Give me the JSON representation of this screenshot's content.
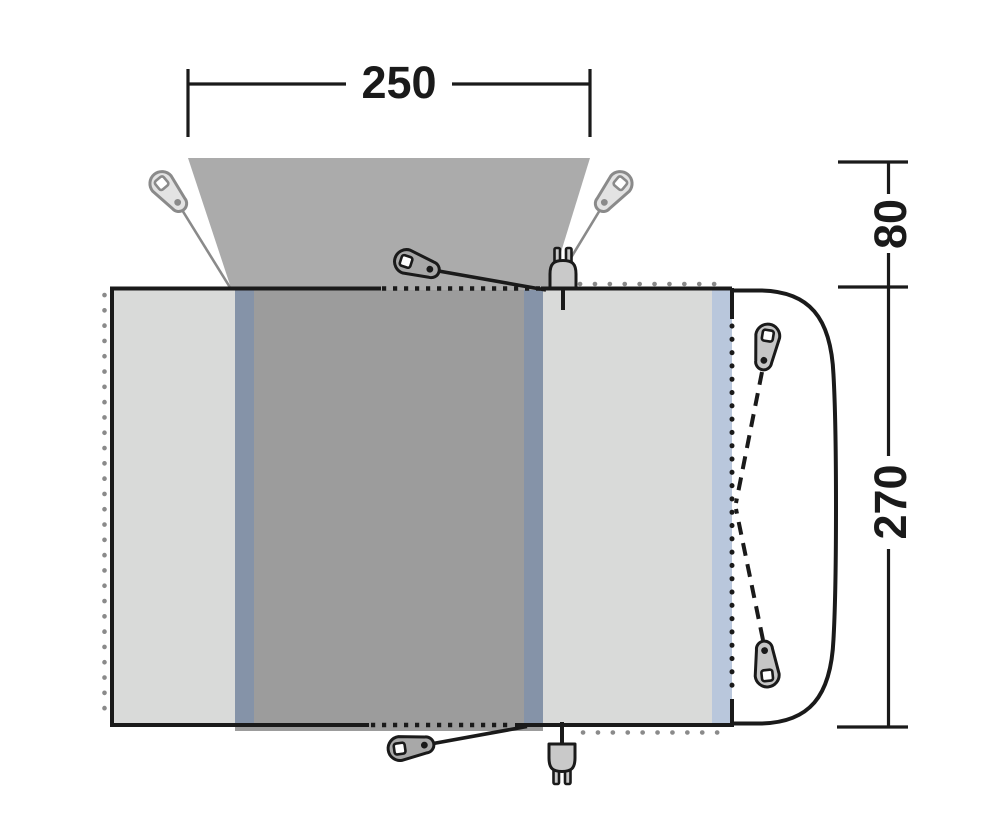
{
  "title": "Awning floor plan diagram",
  "dimensions": {
    "canopy_width": "250",
    "canopy_depth": "80",
    "body_depth": "270"
  },
  "colors": {
    "line": "#1a1a1a",
    "soft_gray": "#8a8a8a",
    "canopy": "#ababab",
    "panel_light": "#d9dad9",
    "panel_dark": "#9c9c9c",
    "strip_slate": "#8593a8",
    "strip_blue": "#b9c7dc",
    "peg_light_fill": "#e3e3e3",
    "peg_mid_fill": "#a8a8a8",
    "peg_gray_fill": "#c6c6c6",
    "plug_fill": "#c9c9c9",
    "vehicle_area": "#ffffff"
  },
  "icons": {
    "peg_canopy_left": "tent-peg-icon",
    "peg_canopy_right": "tent-peg-icon",
    "peg_front_top": "tent-peg-icon",
    "peg_front_bottom": "tent-peg-icon",
    "peg_vehicle_top": "tent-peg-icon",
    "peg_vehicle_bottom": "tent-peg-icon",
    "plug_top": "power-plug-icon",
    "plug_bottom": "power-plug-icon"
  }
}
